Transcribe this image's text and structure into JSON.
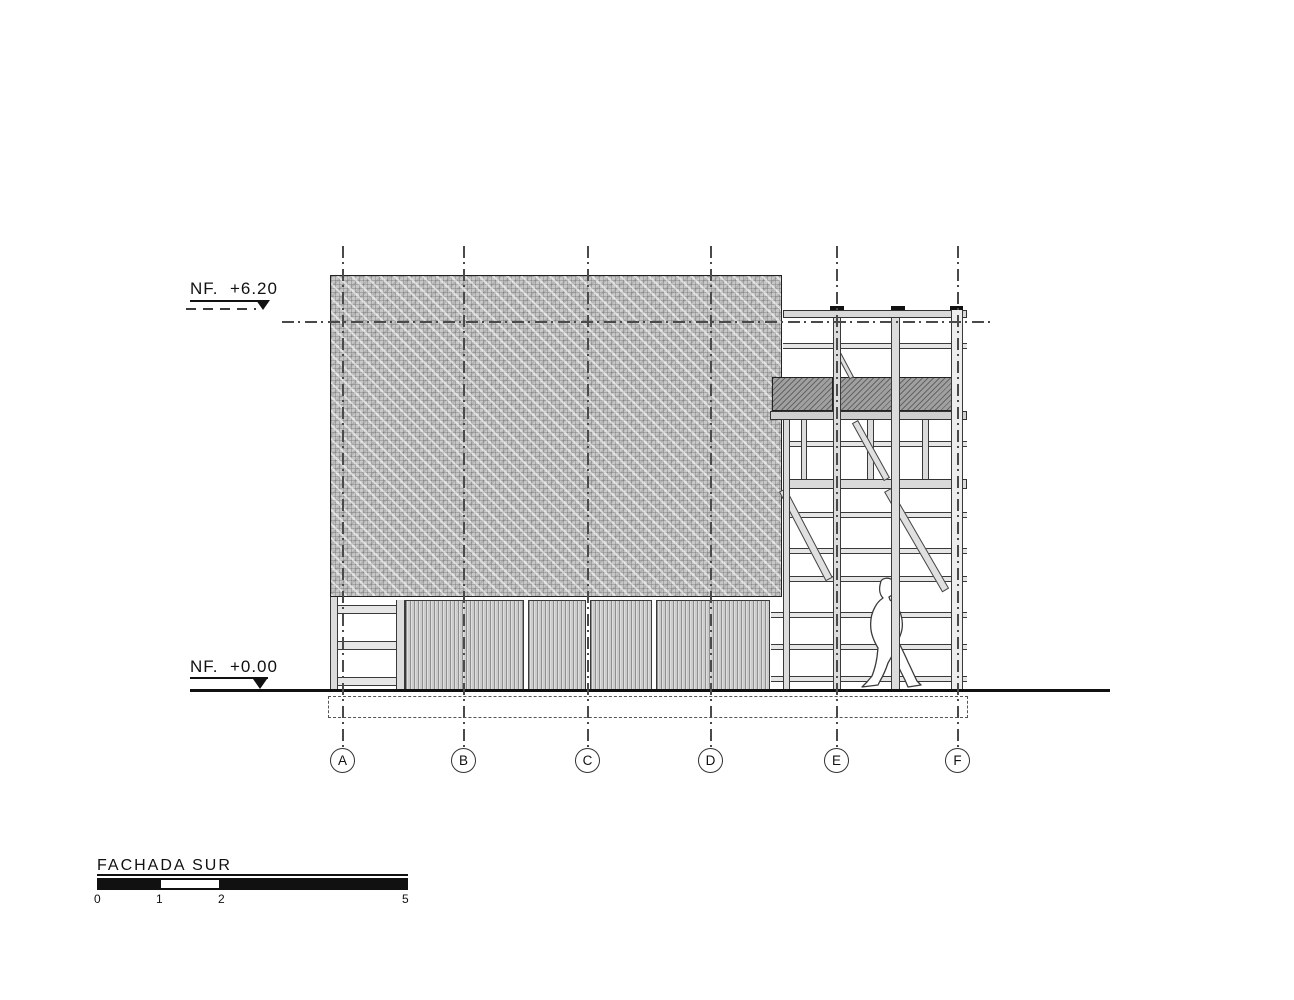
{
  "drawing": {
    "title": "FACHADA SUR",
    "levels": {
      "top": "NF.  +6.20",
      "ground": "NF.  +0.00"
    },
    "grid_axes": [
      "A",
      "B",
      "C",
      "D",
      "E",
      "F"
    ],
    "scale_bar": {
      "ticks": [
        "0",
        "1",
        "2",
        "5"
      ]
    },
    "colors": {
      "line": "#2a2a2a",
      "facade_hatch": "#c7c7c7",
      "siding": "#cccccc",
      "balustrade": "#a0a0a0"
    }
  }
}
